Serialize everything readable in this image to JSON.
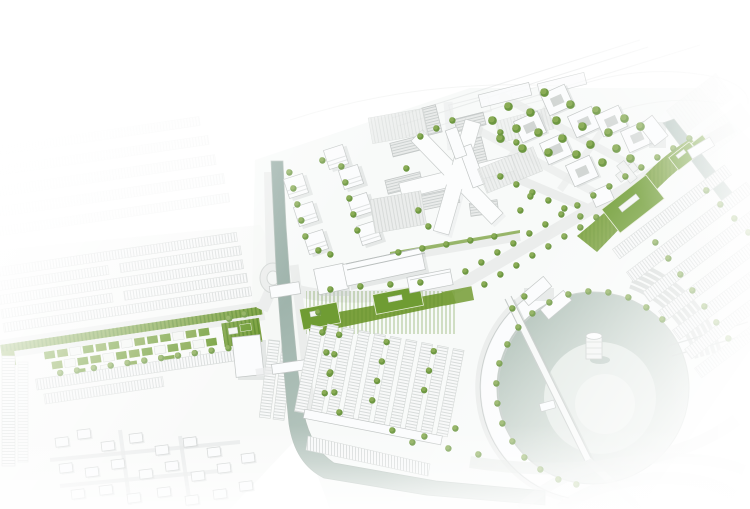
{
  "scene": {
    "aria_label": "Urban masterplan aerial rendering with white buildings, green roofs, canal and circular harbor basin",
    "view": "axonometric-aerial",
    "edges": "fade-to-white"
  },
  "palette": {
    "background": "#ffffff",
    "paper": "#f3f5f4",
    "line": "#c2c6c5",
    "line_faint": "#d4d8d6",
    "road": "#ebedec",
    "road_edge": "#d2d6d4",
    "building_top": "#fbfcfd",
    "building_side": "#dadedd",
    "shadow": "#c8cecc",
    "canal_dark": "#8da59d",
    "canal_light": "#c6d1cb",
    "harbor": "#aebfb6",
    "harbor_light": "#dfe6e1",
    "green_strip": "#7ba13e",
    "green_roof": "#6f9c33",
    "green_dark": "#5e8c2b",
    "tree": "#8aac55",
    "tree_dark": "#6d9741"
  },
  "features": [
    {
      "name": "existing-housing-context",
      "category": "context"
    },
    {
      "name": "green-boulevard",
      "category": "landscape",
      "color_key": "green_strip"
    },
    {
      "name": "patchwork-roofscape",
      "category": "landscape"
    },
    {
      "name": "canal",
      "category": "water",
      "color_key": "canal_dark"
    },
    {
      "name": "roundabout",
      "category": "infrastructure"
    },
    {
      "name": "cube-tower-quarter",
      "category": "buildings"
    },
    {
      "name": "market-hall",
      "category": "buildings"
    },
    {
      "name": "star-plaza",
      "category": "buildings"
    },
    {
      "name": "courtyard-apartment-quarter",
      "category": "buildings"
    },
    {
      "name": "green-roof-strip-central",
      "category": "landscape",
      "color_key": "green_roof"
    },
    {
      "name": "green-roof-strip-east",
      "category": "landscape",
      "color_key": "green_roof"
    },
    {
      "name": "terraced-housing-rows",
      "category": "buildings"
    },
    {
      "name": "harbor-basin",
      "category": "water",
      "color_key": "harbor"
    },
    {
      "name": "crescent-quay",
      "category": "buildings"
    },
    {
      "name": "harbor-bridge",
      "category": "infrastructure"
    },
    {
      "name": "harbor-tower",
      "category": "buildings"
    },
    {
      "name": "suburban-houses",
      "category": "context"
    },
    {
      "name": "street-trees",
      "category": "landscape",
      "color_key": "tree"
    },
    {
      "name": "highway-context",
      "category": "context"
    }
  ]
}
